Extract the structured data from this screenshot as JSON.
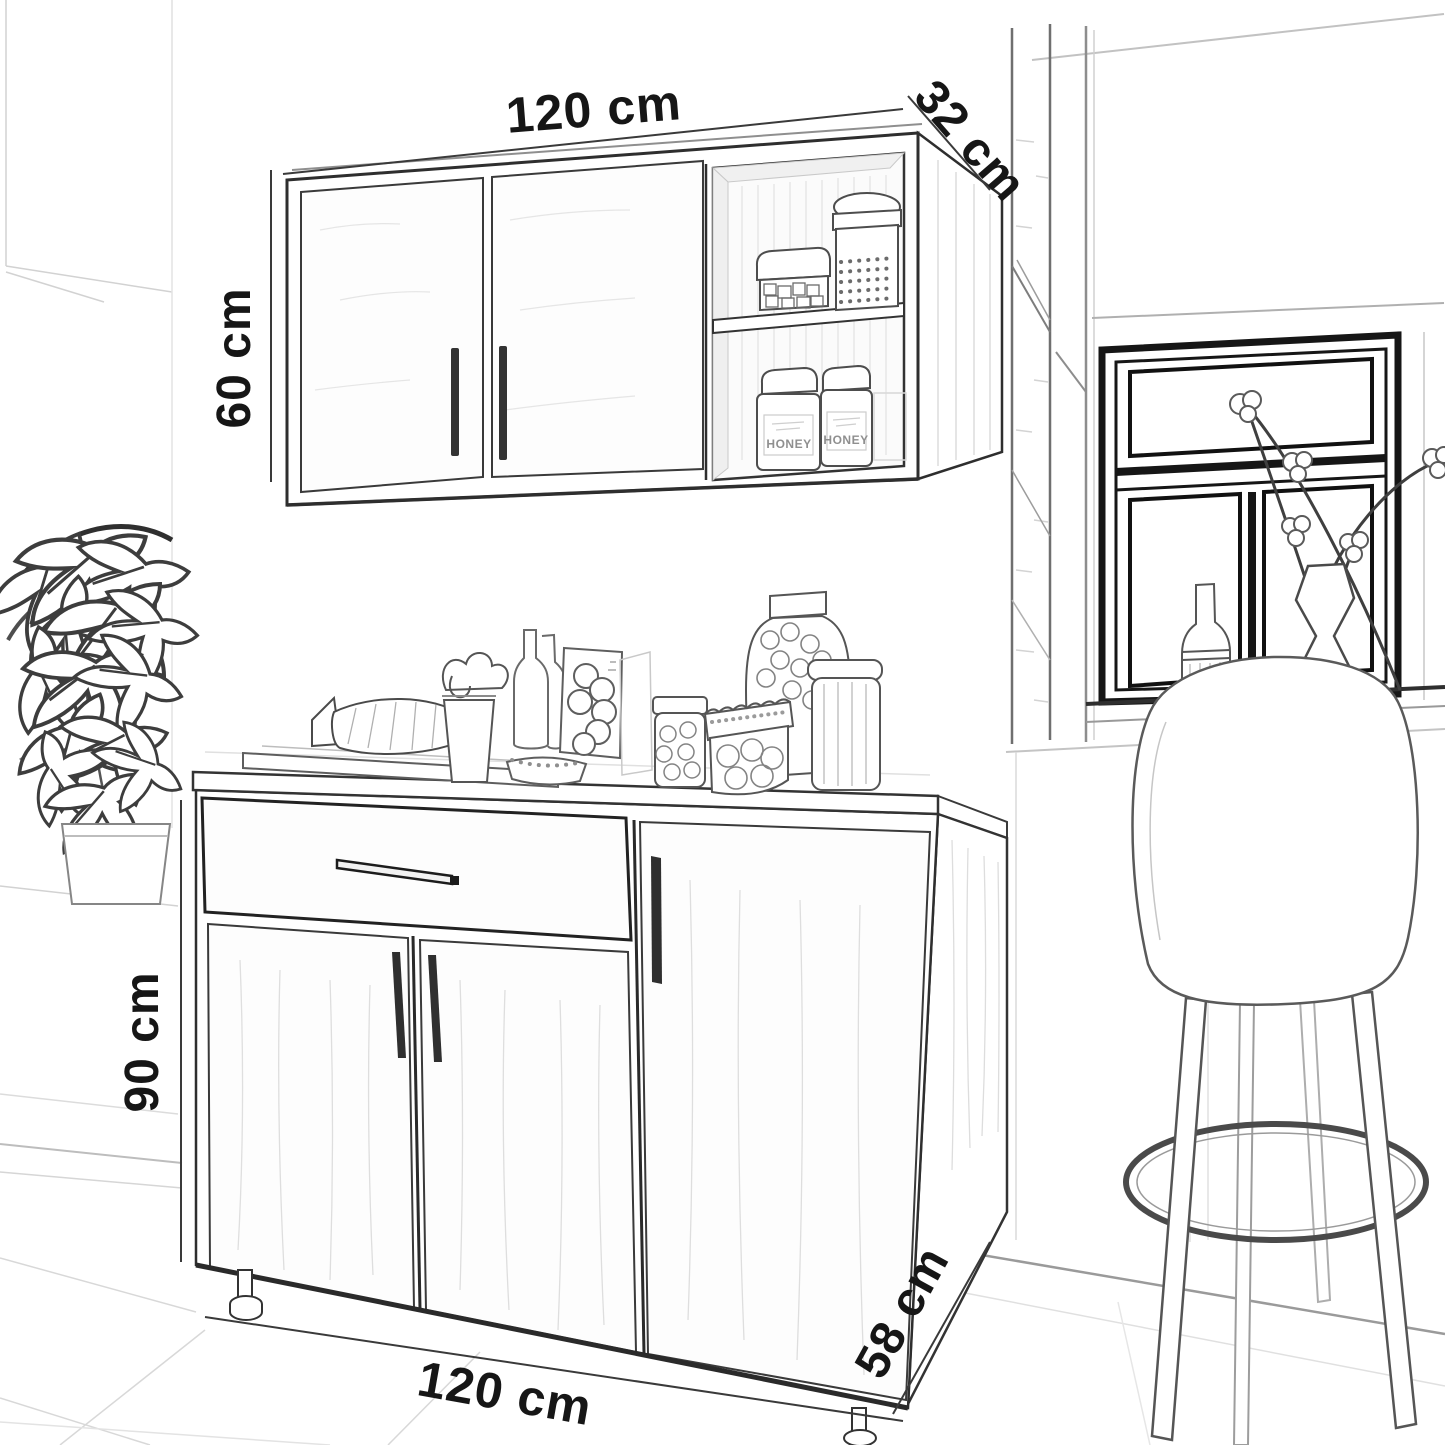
{
  "scene": {
    "kind": "pencil sketch dimension drawing",
    "subject": "kitchen wall cabinet and base cabinet set with open shelves, jars, bar stool, window and houseplant"
  },
  "dimensions": {
    "wall_cabinet": {
      "width": "120 cm",
      "depth": "32 cm",
      "height": "60 cm"
    },
    "base_cabinet": {
      "height": "90 cm",
      "width": "120 cm",
      "depth": "58 cm"
    }
  },
  "jar_labels": {
    "honey_left": "HONEY",
    "honey_right": "HONEY"
  },
  "palette": {
    "ink": "#2e2e2e",
    "mid": "#6a6a6a",
    "faint": "#b5b5b5",
    "window_frame": "#161616",
    "background": "#ffffff"
  }
}
